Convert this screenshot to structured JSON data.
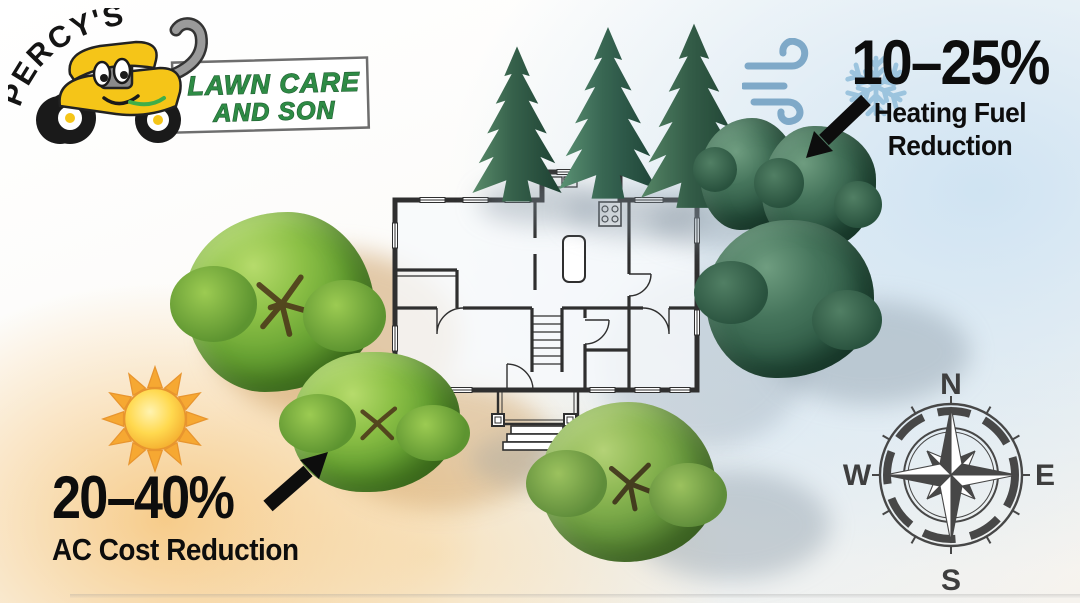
{
  "meta": {
    "title": "Strategic tree placement energy savings infographic",
    "scene": "Top-down house floor plan with windbreak evergreens and shade trees"
  },
  "logo": {
    "owner": "PERCY'S",
    "line1": "LAWN CARE",
    "line2": "AND SON"
  },
  "heating_callout": {
    "value": "10–25%",
    "label_line1": "Heating Fuel",
    "label_line2": "Reduction",
    "icons": [
      "wind-icon",
      "snowflake-icon",
      "arrow-down-left-icon"
    ]
  },
  "cooling_callout": {
    "value": "20–40%",
    "label": "AC Cost Reduction",
    "icons": [
      "sun-icon",
      "arrow-up-right-icon"
    ]
  },
  "compass": {
    "n": "N",
    "e": "E",
    "s": "S",
    "w": "W"
  },
  "colors": {
    "text_black": "#0d0d0d",
    "logo_green": "#2e8b45",
    "logo_green_outline": "#1d5a2e",
    "mower_yellow": "#f5c518",
    "wind_blue": "#7fa9c8",
    "snow_blue": "#9cc4de",
    "sun_yellow": "#ffd94f",
    "sun_ray_orange": "#f6a832",
    "evergreen": "#2e5a45",
    "deciduous": "#69a434",
    "compass_gray": "#474747",
    "wall_ink": "#2f2f2f",
    "cool_bg_tint": "#cde2f2",
    "warm_bg_tint": "#f6c478"
  }
}
